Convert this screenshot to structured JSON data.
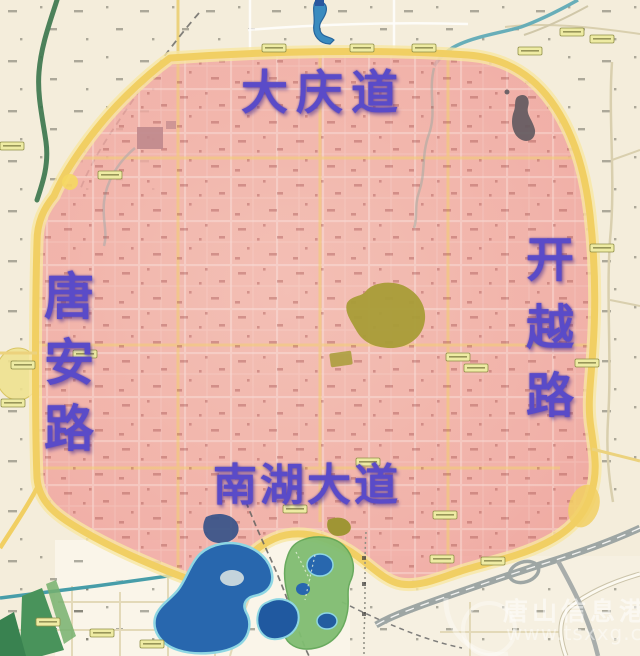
{
  "map": {
    "type": "city-road-map-with-highlighted-zone",
    "highlighted_region_roads": {
      "north": "大庆道",
      "west": "唐安路",
      "east": "开越路",
      "south": "南湖大道"
    },
    "watermark": {
      "site_name": "唐山信息港",
      "url": "www.tsxxg.com"
    },
    "colors": {
      "highlight_fill": "#f19c98",
      "highlight_border": "#f2cf5e",
      "road_label_text": "#5a4bc8",
      "water_blue": "#1c60ae",
      "park_green": "#7abc6d",
      "base_map": "#f5efdd"
    }
  }
}
